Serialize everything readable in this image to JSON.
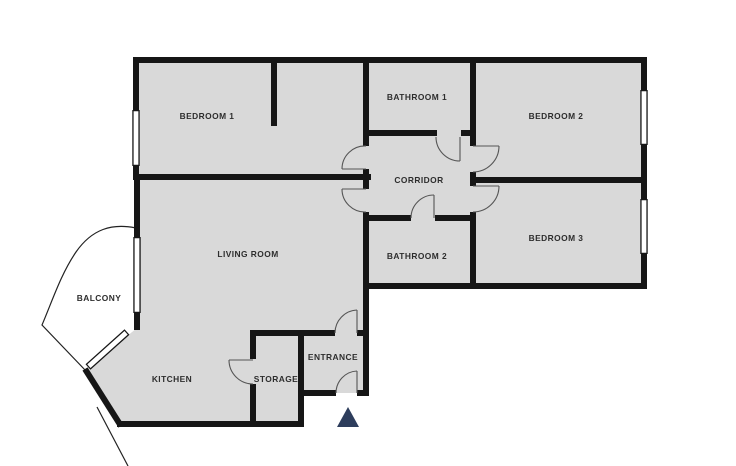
{
  "colors": {
    "background": "#ffffff",
    "floor": "#d9d9d9",
    "wall": "#161616",
    "window_frame": "#161616",
    "window_fill": "#ffffff",
    "door": "#555555",
    "balcony_line": "#222222",
    "label": "#2d2d2d",
    "marker": "#2d3d5c"
  },
  "floor_outline": [
    [
      136,
      60
    ],
    [
      644,
      60
    ],
    [
      644,
      286
    ],
    [
      366,
      286
    ],
    [
      366,
      393
    ],
    [
      301,
      393
    ],
    [
      301,
      424
    ],
    [
      119,
      424
    ],
    [
      85,
      370
    ],
    [
      137,
      328
    ],
    [
      137,
      60
    ]
  ],
  "rooms": [
    {
      "id": "bedroom-1",
      "label": "BEDROOM 1",
      "x": 207,
      "y": 117
    },
    {
      "id": "bathroom-1",
      "label": "BATHROOM 1",
      "x": 417,
      "y": 98
    },
    {
      "id": "bedroom-2",
      "label": "BEDROOM 2",
      "x": 556,
      "y": 117
    },
    {
      "id": "corridor",
      "label": "CORRIDOR",
      "x": 419,
      "y": 181
    },
    {
      "id": "bedroom-3",
      "label": "BEDROOM 3",
      "x": 556,
      "y": 239
    },
    {
      "id": "bathroom-2",
      "label": "BATHROOM 2",
      "x": 417,
      "y": 257
    },
    {
      "id": "living-room",
      "label": "LIVING ROOM",
      "x": 248,
      "y": 255
    },
    {
      "id": "balcony",
      "label": "BALCONY",
      "x": 99,
      "y": 299
    },
    {
      "id": "kitchen",
      "label": "KITCHEN",
      "x": 172,
      "y": 380
    },
    {
      "id": "storage",
      "label": "STORAGE",
      "x": 276,
      "y": 380
    },
    {
      "id": "entrance",
      "label": "ENTRANCE",
      "x": 333,
      "y": 358
    }
  ],
  "walls": [
    {
      "name": "exterior-top",
      "seg": [
        133,
        60,
        647,
        60
      ]
    },
    {
      "name": "exterior-right",
      "seg": [
        644,
        57,
        644,
        289
      ]
    },
    {
      "name": "exterior-bottom-right-wing",
      "seg": [
        363,
        286,
        647,
        286
      ]
    },
    {
      "name": "exterior-left-upper",
      "seg": [
        136,
        57,
        136,
        177
      ]
    },
    {
      "name": "bedroom1-bottom",
      "seg": [
        133,
        177,
        371,
        177
      ]
    },
    {
      "name": "exterior-left-living",
      "seg": [
        137,
        174,
        137,
        330
      ]
    },
    {
      "name": "kitchen-diagonal",
      "seg": [
        85,
        369,
        121,
        426
      ]
    },
    {
      "name": "exterior-bottom-kitchen",
      "seg": [
        117,
        424,
        304,
        424
      ]
    },
    {
      "name": "storage-left-upper",
      "seg": [
        253,
        330,
        253,
        359
      ]
    },
    {
      "name": "storage-left-lower",
      "seg": [
        253,
        384,
        253,
        427
      ]
    },
    {
      "name": "hall-top-left",
      "seg": [
        250,
        333,
        335,
        333
      ]
    },
    {
      "name": "hall-top-right",
      "seg": [
        357,
        333,
        369,
        333
      ]
    },
    {
      "name": "storage-entrance-divider",
      "seg": [
        301,
        330,
        301,
        427
      ]
    },
    {
      "name": "entrance-bottom-left",
      "seg": [
        298,
        393,
        336,
        393
      ]
    },
    {
      "name": "entrance-bottom-right",
      "seg": [
        357,
        393,
        369,
        393
      ]
    },
    {
      "name": "center-plane-upper",
      "seg": [
        366,
        57,
        366,
        146
      ]
    },
    {
      "name": "center-plane-mid",
      "seg": [
        366,
        169,
        366,
        189
      ]
    },
    {
      "name": "center-plane-lower",
      "seg": [
        366,
        212,
        366,
        396
      ]
    },
    {
      "name": "right-plane-upper",
      "seg": [
        473,
        57,
        473,
        146
      ]
    },
    {
      "name": "right-plane-mid",
      "seg": [
        473,
        172,
        473,
        186
      ]
    },
    {
      "name": "right-plane-lower",
      "seg": [
        473,
        212,
        473,
        289
      ]
    },
    {
      "name": "corridor-top-left",
      "seg": [
        366,
        133,
        437,
        133
      ]
    },
    {
      "name": "corridor-top-right",
      "seg": [
        461,
        133,
        473,
        133
      ]
    },
    {
      "name": "corridor-bottom-left",
      "seg": [
        363,
        218,
        411,
        218
      ]
    },
    {
      "name": "corridor-bottom-right",
      "seg": [
        435,
        218,
        476,
        218
      ]
    },
    {
      "name": "bedroom2-bedroom3-divider",
      "seg": [
        470,
        180,
        647,
        180
      ]
    },
    {
      "name": "bedroom1-partition",
      "seg": [
        274,
        57,
        274,
        126
      ]
    }
  ],
  "windows": [
    {
      "name": "window-bedroom-1",
      "seg": [
        136,
        110,
        136,
        166
      ]
    },
    {
      "name": "window-living-room",
      "seg": [
        137,
        237,
        137,
        313
      ]
    },
    {
      "name": "window-kitchen-diagonal",
      "seg": [
        127,
        332,
        88,
        367
      ]
    },
    {
      "name": "window-bedroom-2",
      "seg": [
        644,
        90,
        644,
        145
      ]
    },
    {
      "name": "window-bedroom-3",
      "seg": [
        644,
        199,
        644,
        254
      ]
    }
  ],
  "doors": [
    {
      "name": "door-bathroom-1",
      "leaf": [
        460,
        137,
        460,
        161
      ],
      "arc": "M460,161 A24,24 0 0 1 436,137"
    },
    {
      "name": "door-bathroom-2",
      "leaf": [
        434,
        218,
        434,
        195
      ],
      "arc": "M434,195 A23,23 0 0 0 411,218"
    },
    {
      "name": "door-bedroom-1",
      "leaf": [
        366,
        169,
        342,
        169
      ],
      "arc": "M342,169 A23,23 0 0 1 366,146"
    },
    {
      "name": "door-living-room",
      "leaf": [
        366,
        189,
        342,
        189
      ],
      "arc": "M342,189 A23,23 0 0 0 366,212"
    },
    {
      "name": "door-bedroom-2",
      "leaf": [
        473,
        146,
        499,
        146
      ],
      "arc": "M499,146 A26,26 0 0 1 473,172"
    },
    {
      "name": "door-bedroom-3",
      "leaf": [
        473,
        186,
        499,
        186
      ],
      "arc": "M499,186 A26,26 0 0 1 473,212"
    },
    {
      "name": "door-storage",
      "leaf": [
        253,
        360,
        229,
        360
      ],
      "arc": "M229,360 A24,24 0 0 0 253,384"
    },
    {
      "name": "door-hall",
      "leaf": [
        357,
        333,
        357,
        310
      ],
      "arc": "M357,310 A23,23 0 0 0 335,333"
    },
    {
      "name": "door-front",
      "leaf": [
        357,
        393,
        357,
        371
      ],
      "arc": "M357,371 A22,22 0 0 0 336,393"
    }
  ],
  "balcony_outline": [
    "M136,228 C112,223 92,229 76,252 C61,274 53,299 42,325 L86,371",
    "M97,407 L128,466"
  ],
  "entrance_marker": {
    "points": [
      [
        348,
        407
      ],
      [
        337,
        427
      ],
      [
        359,
        427
      ]
    ]
  }
}
